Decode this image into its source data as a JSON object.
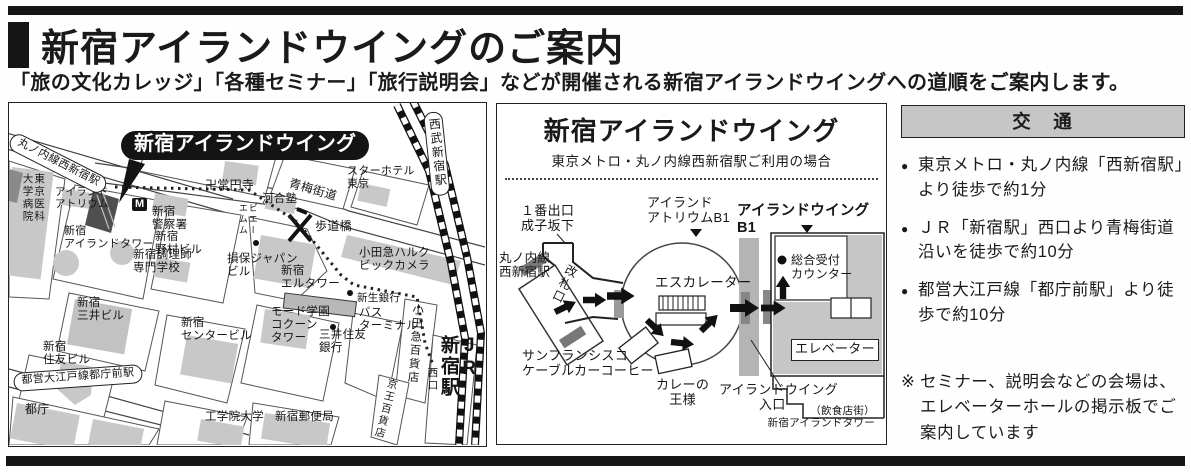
{
  "header": {
    "title": "新宿アイランドウイングのご案内",
    "subtitle": "「旅の文化カレッジ」「各種セミナー」「旅行説明会」などが開催される新宿アイランドウイングへの道順をご案内します。"
  },
  "colors": {
    "ink": "#1a1a1a",
    "building_gray": "#c8c8c8",
    "dark_building": "#4f4f4f",
    "panel_border": "#222222",
    "header_gray": "#c6c6c6"
  },
  "area_map": {
    "labels": [
      {
        "name": "area-callout",
        "text": "新宿アイランドウイング",
        "x": 112,
        "y": 28,
        "fs": 20,
        "cls": "callout"
      },
      {
        "name": "station-marunouchi-nishishinjuku",
        "text": "丸ノ内線西新宿駅",
        "x": 6,
        "y": 28,
        "fs": 11,
        "cls": "oval",
        "rot": 27
      },
      {
        "name": "tokyo-medical-university-hospital",
        "text": "東京医科大学病院",
        "x": 12,
        "y": 70,
        "fs": 10.5,
        "cls": "v",
        "h": 50
      },
      {
        "name": "island-atrium-label",
        "text": "アイランド\nアトリウム",
        "x": 46,
        "y": 84,
        "fs": 10.5
      },
      {
        "name": "shinjuku-island-tower-label",
        "text": "新宿\nアイランドタワー",
        "x": 55,
        "y": 122,
        "fs": 11
      },
      {
        "name": "joenji-temple",
        "text": "卍常円寺",
        "x": 196,
        "y": 76,
        "fs": 12
      },
      {
        "name": "oume-kaido-road",
        "text": "青梅街道",
        "x": 282,
        "y": 74,
        "fs": 12,
        "rot": 16
      },
      {
        "name": "tokyo-metro-icon",
        "text": "M",
        "x": 123,
        "y": 95,
        "fs": 11,
        "cls": "metro"
      },
      {
        "name": "shinjuku-police-station",
        "text": "新宿\n警察署",
        "x": 143,
        "y": 103,
        "fs": 11.5
      },
      {
        "name": "star-hotel-tokyo",
        "text": "スターホテル\n東京",
        "x": 338,
        "y": 62,
        "fs": 11
      },
      {
        "name": "seibu-shinjuku-station",
        "text": "西武新宿駅",
        "x": 414,
        "y": 10,
        "fs": 12,
        "cls": "v station-rect",
        "h": 72,
        "rot": -6
      },
      {
        "name": "kawaijuku",
        "text": "河合塾",
        "x": 253,
        "y": 90,
        "fs": 11.5
      },
      {
        "name": "pedestrian-bridge-label",
        "text": "歩道橋",
        "x": 306,
        "y": 117,
        "fs": 12
      },
      {
        "name": "shinjuku-nomura-bldg",
        "text": "新宿\n野村ビル",
        "x": 146,
        "y": 128,
        "fs": 11.5
      },
      {
        "name": "shinjuku-chorishi-school",
        "text": "新宿調理師\n専門学校",
        "x": 124,
        "y": 146,
        "fs": 11.5
      },
      {
        "name": "sompo-japan-bldg",
        "text": "損保ジャパン\nビル",
        "x": 218,
        "y": 150,
        "fs": 11.5
      },
      {
        "name": "small-shops-label",
        "text": "ビエーエムム",
        "x": 228,
        "y": 100,
        "fs": 9,
        "cls": "v",
        "h": 36
      },
      {
        "name": "shinjuku-l-tower",
        "text": "新宿\nエルタワー",
        "x": 272,
        "y": 162,
        "fs": 11.5
      },
      {
        "name": "shinsei-bank",
        "text": "新生銀行",
        "x": 348,
        "y": 190,
        "fs": 10.5
      },
      {
        "name": "odakyu-halc-biccamera",
        "text": "小田急ハルク\nビックカメラ",
        "x": 350,
        "y": 144,
        "fs": 11.5
      },
      {
        "name": "bus-terminal",
        "text": "バス\nターミナル",
        "x": 350,
        "y": 204,
        "fs": 11.5
      },
      {
        "name": "mode-gakuen-cocoon-tower",
        "text": "モード学園\nコクーン\nタワー",
        "x": 262,
        "y": 203,
        "fs": 11.5
      },
      {
        "name": "smbc-bank",
        "text": "三井住友\n銀行",
        "x": 310,
        "y": 226,
        "fs": 11.5
      },
      {
        "name": "shinjuku-mitsui-bldg",
        "text": "新宿\n三井ビル",
        "x": 68,
        "y": 194,
        "fs": 11.5
      },
      {
        "name": "shinjuku-center-bldg",
        "text": "新宿\nセンタービル",
        "x": 172,
        "y": 214,
        "fs": 11.5
      },
      {
        "name": "shinjuku-sumitomo-bldg",
        "text": "新宿\n住友ビル",
        "x": 34,
        "y": 238,
        "fs": 11.5
      },
      {
        "name": "station-toei-oedo-tochomae",
        "text": "都営大江戸線都庁前駅",
        "x": 4,
        "y": 270,
        "fs": 11,
        "cls": "oval",
        "rot": -4
      },
      {
        "name": "tocho",
        "text": "都庁",
        "x": 16,
        "y": 300,
        "fs": 12
      },
      {
        "name": "kogakuin-university",
        "text": "工学院大学",
        "x": 196,
        "y": 308,
        "fs": 11.5
      },
      {
        "name": "shinjuku-post-office",
        "text": "新宿郵便局",
        "x": 266,
        "y": 308,
        "fs": 11.5
      },
      {
        "name": "odakyu-dept-store",
        "text": "小田急百貨店",
        "x": 402,
        "y": 200,
        "fs": 11.5,
        "cls": "v",
        "h": 86,
        "rot": 4
      },
      {
        "name": "keio-dept-store",
        "text": "京王百貨店",
        "x": 378,
        "y": 274,
        "fs": 10.5,
        "cls": "v",
        "h": 64,
        "rot": 14
      },
      {
        "name": "jr-shinjuku-station",
        "text": "JR\n新宿駅",
        "x": 428,
        "y": 232,
        "fs": 19,
        "cls": "v bold",
        "h": 106
      },
      {
        "name": "nishiguchi-exit",
        "text": "西口",
        "x": 417,
        "y": 264,
        "fs": 10.5,
        "cls": "v",
        "h": 30
      }
    ]
  },
  "route_map": {
    "title": "新宿アイランドウイング",
    "subtitle": "東京メトロ・丸ノ内線西新宿駅ご利用の場合",
    "labels": [
      {
        "name": "exit1-narukozaka",
        "text": "１番出口\n成子坂下",
        "x": 24,
        "y": 14,
        "fs": 13,
        "cls": "ctr"
      },
      {
        "name": "island-atrium-b1",
        "text": "アイランド\nアトリウムB1",
        "x": 150,
        "y": 6,
        "fs": 13
      },
      {
        "name": "island-wing-b1",
        "text": "アイランドウイングB1",
        "x": 240,
        "y": 13,
        "fs": 14.5,
        "cls": "bold"
      },
      {
        "name": "marunouchi-nishishinjuku-station",
        "text": "丸ノ内線\n西新宿駅",
        "x": 2,
        "y": 61,
        "fs": 12.5
      },
      {
        "name": "ticket-gate",
        "text": "改札口",
        "x": 70,
        "y": 72,
        "fs": 12,
        "cls": "v",
        "h": 44,
        "rot": 26
      },
      {
        "name": "escalator-label",
        "text": "エスカレーター",
        "x": 158,
        "y": 85,
        "fs": 13.5
      },
      {
        "name": "reception-counter",
        "text": "総合受付\nカウンター",
        "x": 294,
        "y": 64,
        "fs": 12
      },
      {
        "name": "elevator-label",
        "text": "エレベーター",
        "x": 294,
        "y": 149,
        "fs": 13,
        "cls": "boxed",
        "w": 86
      },
      {
        "name": "san-francisco-cable-car-coffee",
        "text": "サンフランシスコ\nケーブルカーコーヒー",
        "x": 25,
        "y": 159,
        "fs": 13
      },
      {
        "name": "curry-no-osama",
        "text": "カレーの\n王様",
        "x": 159,
        "y": 188,
        "fs": 13,
        "cls": "ctr"
      },
      {
        "name": "island-wing-entrance",
        "text": "アイランドウイング\n　　　入口",
        "x": 222,
        "y": 193,
        "fs": 13
      },
      {
        "name": "restaurant-street-island-tower",
        "text": "（飲食店街）\n新宿アイランドタワー",
        "x": 260,
        "y": 216,
        "fs": 10.5,
        "cls": "rt",
        "w": 118
      }
    ]
  },
  "transport": {
    "header": "交　通",
    "bullet": "●",
    "items": [
      "東京メトロ・丸ノ内線「西新宿駅」より徒歩で約1分",
      "ＪＲ「新宿駅」西口より青梅街道沿いを徒歩で約10分",
      "都営大江戸線「都庁前駅」より徒歩で約10分"
    ],
    "note_mark": "※",
    "note": "セミナー、説明会などの会場は、エレベーターホールの掲示板でご案内しています"
  }
}
